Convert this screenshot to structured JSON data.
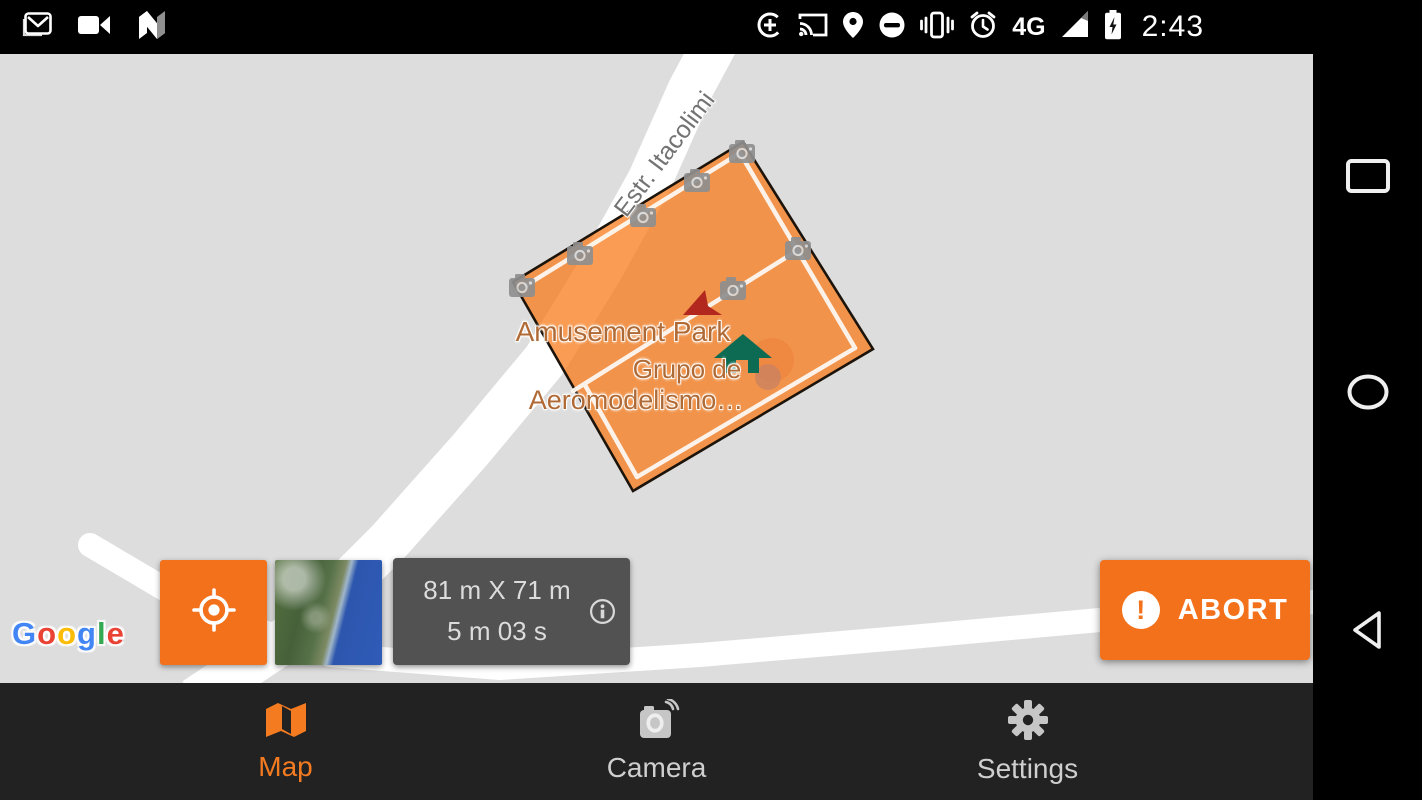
{
  "status_bar": {
    "time": "2:43",
    "network": "4G"
  },
  "map_labels": {
    "park": "Amusement Park",
    "club_line1": "Grupo de",
    "club_line2": "Aeromodelismo…",
    "road": "Estr. Itacolimi"
  },
  "google_logo": {
    "letters": [
      "G",
      "o",
      "o",
      "g",
      "l",
      "e"
    ]
  },
  "mission_info": {
    "dimensions": "81 m X 71 m",
    "duration": "5 m 03 s"
  },
  "telemetry": {
    "status": "Connected",
    "model": "Phantom 4",
    "drone_battery": "92%",
    "rc_battery": "92%",
    "satellite_count": "17",
    "sd_capacity": "1497",
    "speed_label": "Speed:",
    "speed": "3.40 m/s",
    "alt_label": "Alt:",
    "altitude": "59.90 m / 60.00 m",
    "distance": "18.13 m away"
  },
  "abort": {
    "label": "ABORT",
    "exclamation": "!"
  },
  "tabs": [
    {
      "label": "Map"
    },
    {
      "label": "Camera"
    },
    {
      "label": "Settings"
    }
  ],
  "colors": {
    "accent_orange": "#F4711C",
    "polygon_fill": "rgba(248,118,16,0.72)",
    "map_background": "#DDDDDD"
  }
}
